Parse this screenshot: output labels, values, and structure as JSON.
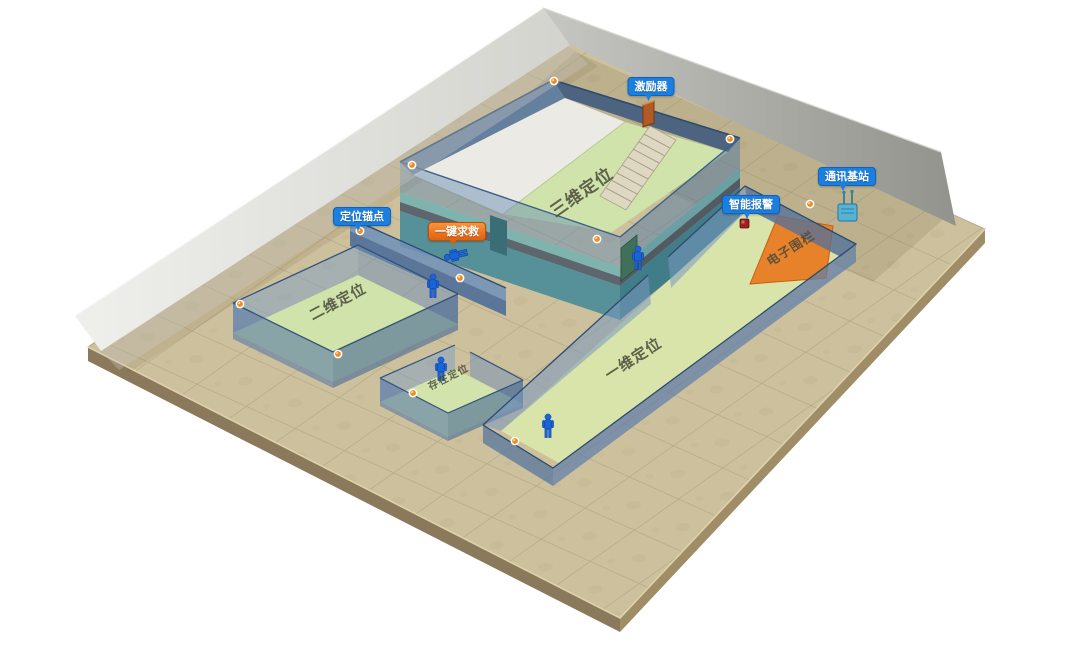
{
  "figure": {
    "type": "isometric-positioning-demo",
    "callouts": {
      "exciter": "激励器",
      "comm_base_station": "通讯基站",
      "smart_alarm": "智能报警",
      "positioning_anchor": "定位锚点",
      "one_key_sos": "一键求救"
    },
    "zones": {
      "three_d": "三维定位",
      "two_d": "二维定位",
      "one_d": "一维定位",
      "presence": "存在定位",
      "electronic_fence": "电子围栏"
    },
    "colors": {
      "callout_blue": "#1b7fe0",
      "callout_orange": "#e8690e",
      "fence_orange": "#e8822a",
      "room_floor_green": "#cfe3aa",
      "wall_blue": "#5581b4",
      "building_teal": "#569199",
      "ground_tan": "#cdc09d",
      "back_wall_gray": "#b9b9b5",
      "person_blue": "#1b64d8",
      "anchor_orange": "#ee8a1c"
    },
    "counts": {
      "standing_persons": 4,
      "lying_persons": 1,
      "anchor_dots": 11
    }
  }
}
